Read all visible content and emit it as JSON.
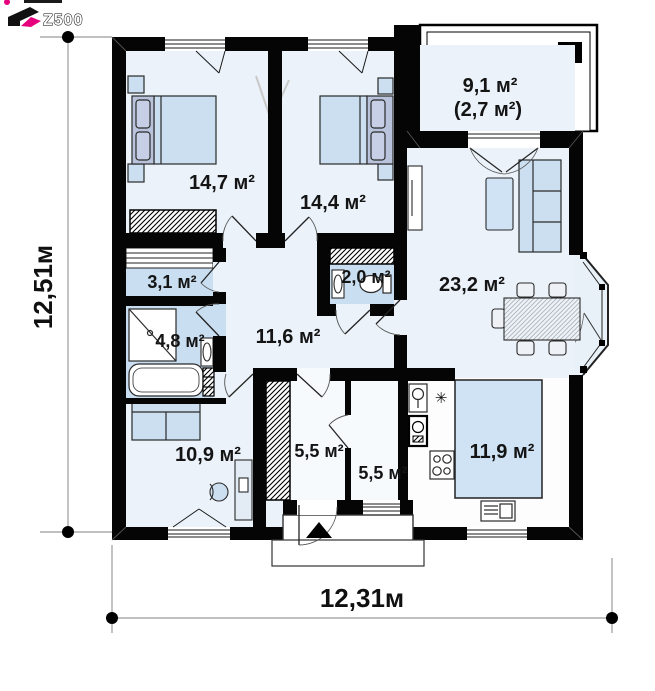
{
  "logo": {
    "brand": "Z500"
  },
  "dimensions": {
    "height_label": "12,51м",
    "width_label": "12,31м"
  },
  "rooms": {
    "bedroom_1": {
      "name": "bedroom",
      "area": "14,7 м²"
    },
    "bedroom_2": {
      "name": "bedroom",
      "area": "14,4 м²"
    },
    "terrace": {
      "name": "terrace",
      "area_total": "9,1 м²",
      "area_secondary": "(2,7 м²)"
    },
    "living_room": {
      "name": "living room",
      "area": "23,2 м²"
    },
    "hallway": {
      "name": "hallway",
      "area": "11,6 м²"
    },
    "wardrobe": {
      "name": "wardrobe",
      "area": "3,1 м²"
    },
    "bathroom": {
      "name": "bathroom",
      "area": "4,8 м²"
    },
    "wc": {
      "name": "wc",
      "area": "2,0 м²"
    },
    "office": {
      "name": "office",
      "area": "10,9 м²"
    },
    "vestibule": {
      "name": "vestibule",
      "area": "5,5 м²"
    },
    "utility": {
      "name": "utility",
      "area": "5,5 м²"
    },
    "kitchen": {
      "name": "kitchen",
      "area": "11,9 м²"
    }
  },
  "symbols": {
    "hob": "✳"
  },
  "colors": {
    "wall": "#000000",
    "brand_magenta": "#e6007e",
    "floor_light": "#ebf2f9",
    "floor_blue": "#c9def0",
    "kitchen_blue": "#cfe3f5"
  }
}
